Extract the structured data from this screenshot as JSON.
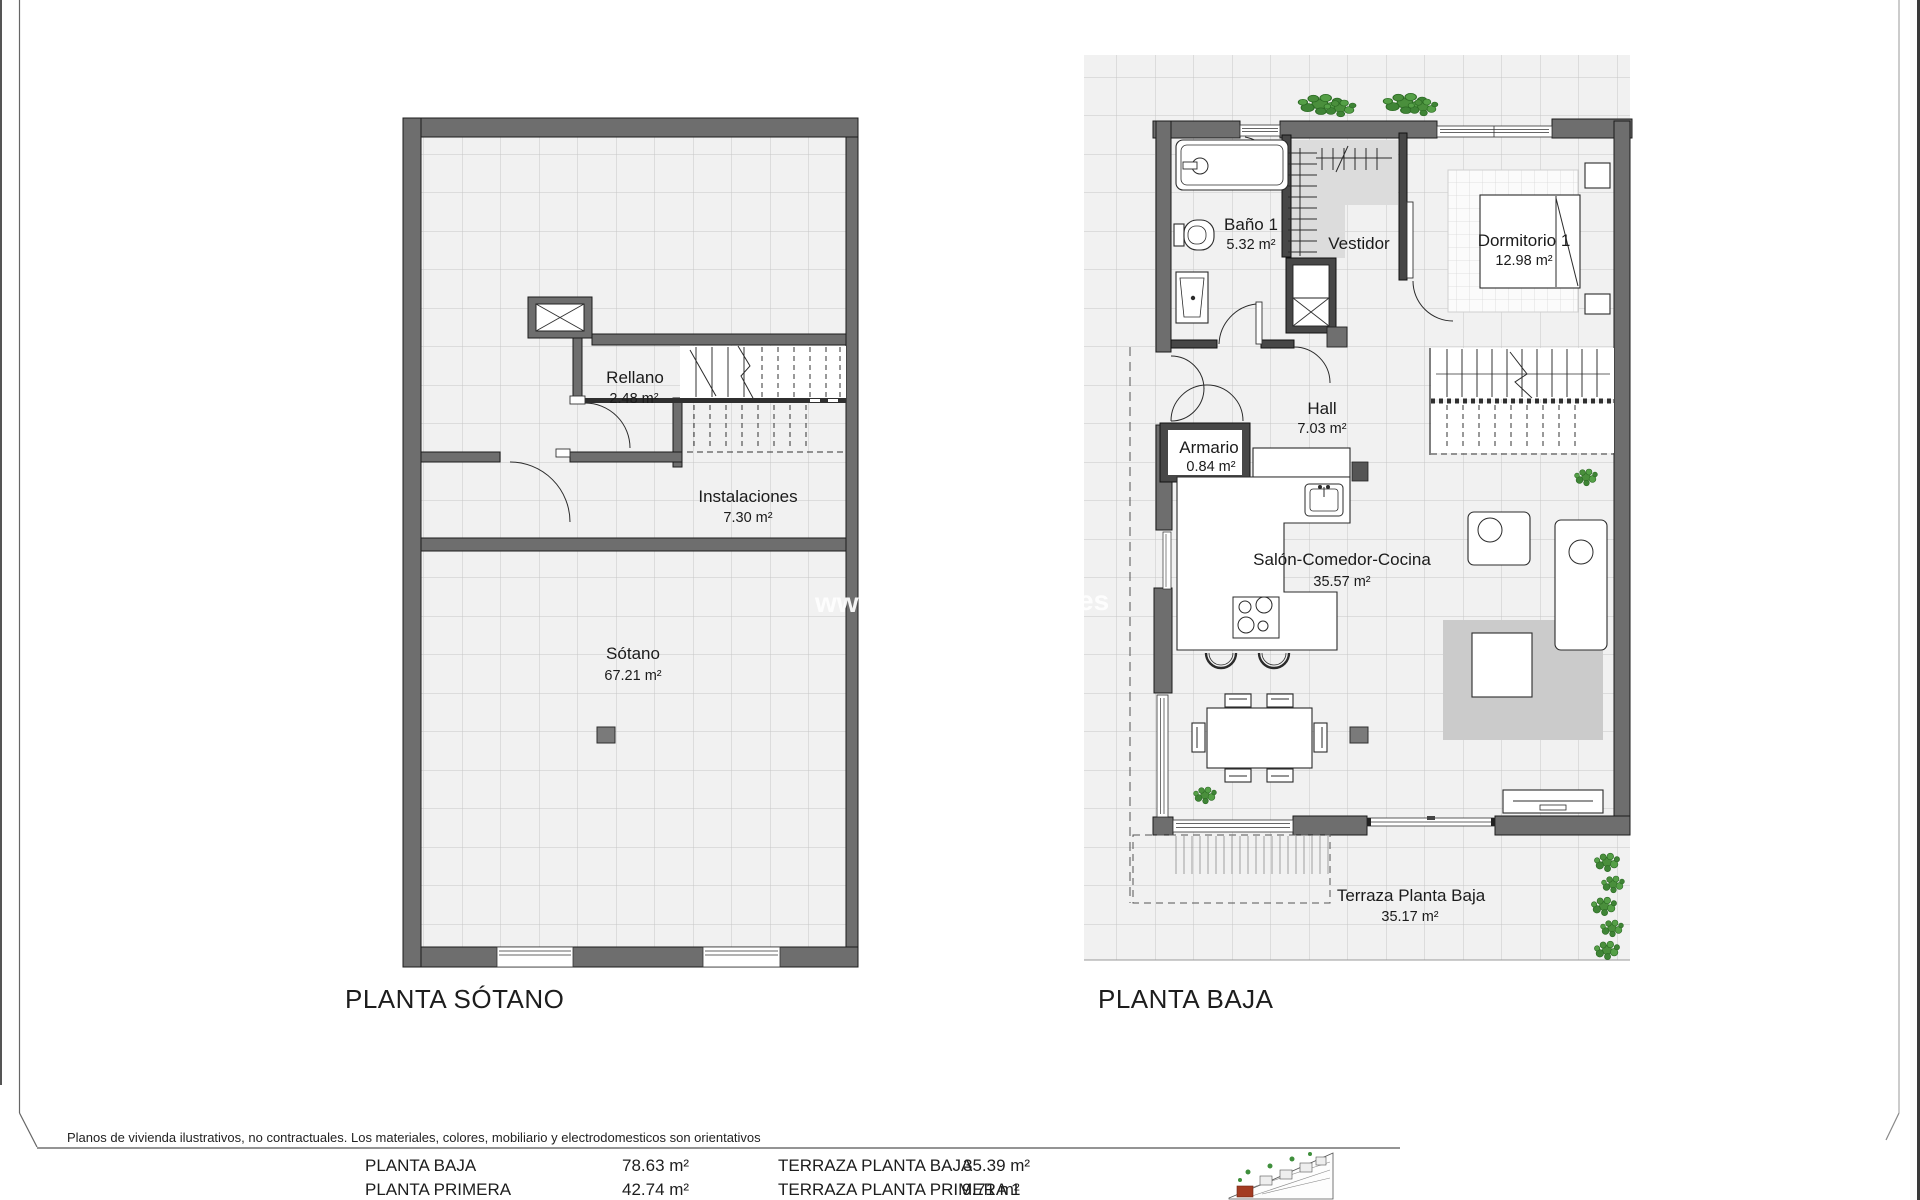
{
  "document": {
    "disclaimer": "Planos de vivienda ilustrativos, no contractuales. Los materiales, colores, mobiliario y electrodomesticos son orientativos",
    "watermark": {
      "left": "www",
      "right": "es"
    }
  },
  "plans": [
    {
      "title": "PLANTA SÓTANO",
      "rooms": [
        {
          "name": "Rellano",
          "area": "2.48 m²"
        },
        {
          "name": "Instalaciones",
          "area": "7.30 m²"
        },
        {
          "name": "Sótano",
          "area": "67.21 m²"
        }
      ]
    },
    {
      "title": "PLANTA BAJA",
      "rooms": [
        {
          "name": "Baño 1",
          "area": "5.32 m²"
        },
        {
          "name": "Vestidor",
          "area": ""
        },
        {
          "name": "Dormitorio 1",
          "area": "12.98 m²"
        },
        {
          "name": "Hall",
          "area": "7.03 m²"
        },
        {
          "name": "Armario",
          "area": "0.84 m²"
        },
        {
          "name": "Salón-Comedor-Cocina",
          "area": "35.57 m²"
        },
        {
          "name": "Terraza Planta Baja",
          "area": "35.17 m²"
        }
      ]
    }
  ],
  "summary": {
    "rows": [
      {
        "label": "PLANTA BAJA",
        "value": "78.63 m²"
      },
      {
        "label": "PLANTA PRIMERA",
        "value": "42.74 m²"
      },
      {
        "label": "TERRAZA PLANTA BAJA",
        "value": "35.39 m²"
      },
      {
        "label": "TERRAZA PLANTA PRIMERA 1",
        "value": "9.71 m²"
      }
    ]
  },
  "colors": {
    "wall": "#6e6e6e",
    "wall_dark": "#474747",
    "tile_bg": "#f1f1f1",
    "tile_line": "#c6c6c6",
    "plant_green": "#4a8f3c",
    "rug_gray": "#cbcbcb",
    "logo_red": "#a33b22"
  }
}
